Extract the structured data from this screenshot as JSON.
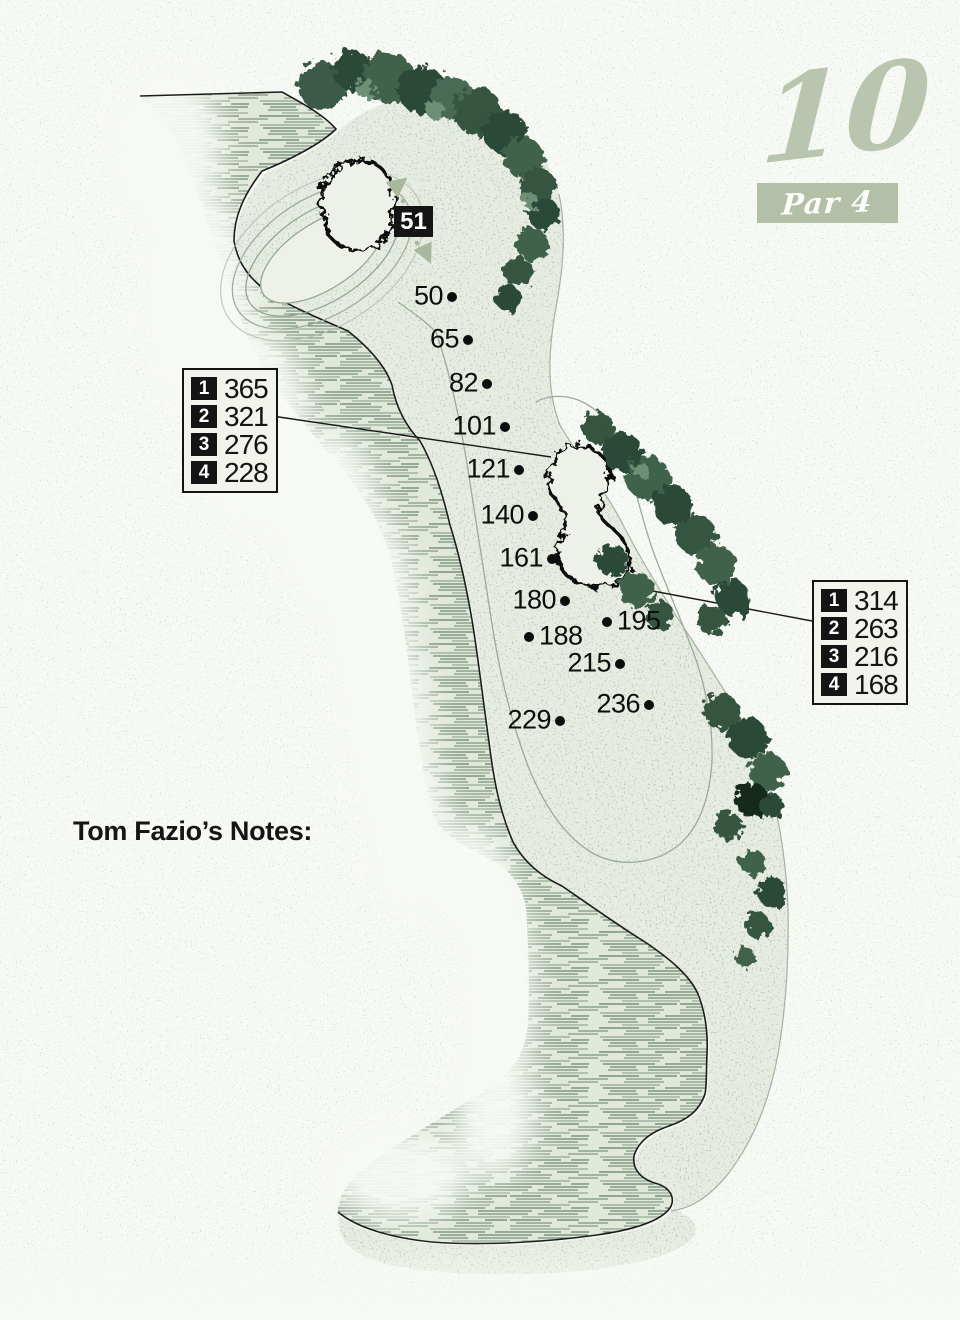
{
  "hole_header": {
    "number": "10",
    "par": "Par 4"
  },
  "palette": {
    "sage": "#b3c0a7",
    "ink": "#141414",
    "water_line": "#5d7a64",
    "ground": "#e7ece2",
    "tree_dark": "#2c4a38",
    "tee_red": "#d8392b",
    "tee_blue": "#2279b8"
  },
  "carry_table_left": {
    "rows": [
      {
        "tee": "1",
        "yards": "365"
      },
      {
        "tee": "2",
        "yards": "321"
      },
      {
        "tee": "3",
        "yards": "276"
      },
      {
        "tee": "4",
        "yards": "228"
      }
    ]
  },
  "carry_table_right": {
    "rows": [
      {
        "tee": "1",
        "yards": "314"
      },
      {
        "tee": "2",
        "yards": "263"
      },
      {
        "tee": "3",
        "yards": "216"
      },
      {
        "tee": "4",
        "yards": "168"
      }
    ]
  },
  "green_depth_label": "51",
  "yardage_markers": [
    {
      "label": "50",
      "x": 452,
      "y": 297,
      "side": "left"
    },
    {
      "label": "65",
      "x": 468,
      "y": 340,
      "side": "left"
    },
    {
      "label": "82",
      "x": 487,
      "y": 384,
      "side": "left"
    },
    {
      "label": "101",
      "x": 505,
      "y": 427,
      "side": "left"
    },
    {
      "label": "121",
      "x": 519,
      "y": 470,
      "side": "left"
    },
    {
      "label": "140",
      "x": 533,
      "y": 516,
      "side": "left"
    },
    {
      "label": "161",
      "x": 552,
      "y": 559,
      "side": "left"
    },
    {
      "label": "180",
      "x": 565,
      "y": 601,
      "side": "left"
    },
    {
      "label": "195",
      "x": 607,
      "y": 622,
      "side": "right"
    },
    {
      "label": "188",
      "x": 529,
      "y": 637,
      "side": "right"
    },
    {
      "label": "215",
      "x": 620,
      "y": 664,
      "side": "left"
    },
    {
      "label": "236",
      "x": 649,
      "y": 705,
      "side": "left"
    },
    {
      "label": "229",
      "x": 560,
      "y": 721,
      "side": "left"
    }
  ],
  "tee_markers": [
    {
      "number": "4",
      "style": "dot",
      "ball_color": "#d8392b",
      "x": 691,
      "y": 938,
      "w": 44,
      "h": 34,
      "rot": -18,
      "label_x": 710,
      "label_y": 947,
      "wedge": "tl"
    },
    {
      "number": "3",
      "style": "ring",
      "ball_color": "#fdfdfa",
      "x": 728,
      "y": 1036,
      "w": 34,
      "h": 31,
      "rot": 0,
      "label_x": 748,
      "label_y": 1046,
      "wedge": "tl"
    },
    {
      "number": "2",
      "style": "dot",
      "ball_color": "#2279b8",
      "x": 652,
      "y": 1146,
      "w": 42,
      "h": 33,
      "rot": -15,
      "label_x": 669,
      "label_y": 1156,
      "wedge": "tl"
    },
    {
      "number": "1",
      "style": "dot",
      "ball_color": "#121212",
      "x": 421,
      "y": 1233,
      "w": 44,
      "h": 34,
      "rot": -8,
      "label_x": 371,
      "label_y": 1217,
      "wedge": "r"
    }
  ],
  "notes": {
    "title": "Tom Fazio’s Notes:",
    "lines": [
      {
        "text": "The back nine opens with a strong",
        "justify": false,
        "narrow": false
      },
      {
        "text": "cape hole Par 4 that tempts players",
        "justify": false,
        "narrow": false
      },
      {
        "text": "to take an aggressive line over the",
        "justify": true,
        "narrow": false
      },
      {
        "text": "water on their tee shots to effectively",
        "justify": true,
        "narrow": false
      },
      {
        "text": "shorten the hole. Danger lurks in the",
        "justify": true,
        "narrow": false
      },
      {
        "text": "pond down the entire left side as well as",
        "justify": true,
        "narrow": false
      },
      {
        "text": "a large framing bunker right of the landing",
        "justify": true,
        "narrow": false
      },
      {
        "text": "area. The green sits perched on the",
        "justify": true,
        "narrow": false
      },
      {
        "text": "pond with a bunker right, but the",
        "justify": true,
        "narrow": true
      },
      {
        "text": "front of the green is open to a",
        "justify": false,
        "narrow": false
      },
      {
        "text": "low or running approach.",
        "justify": false,
        "narrow": false
      }
    ]
  }
}
